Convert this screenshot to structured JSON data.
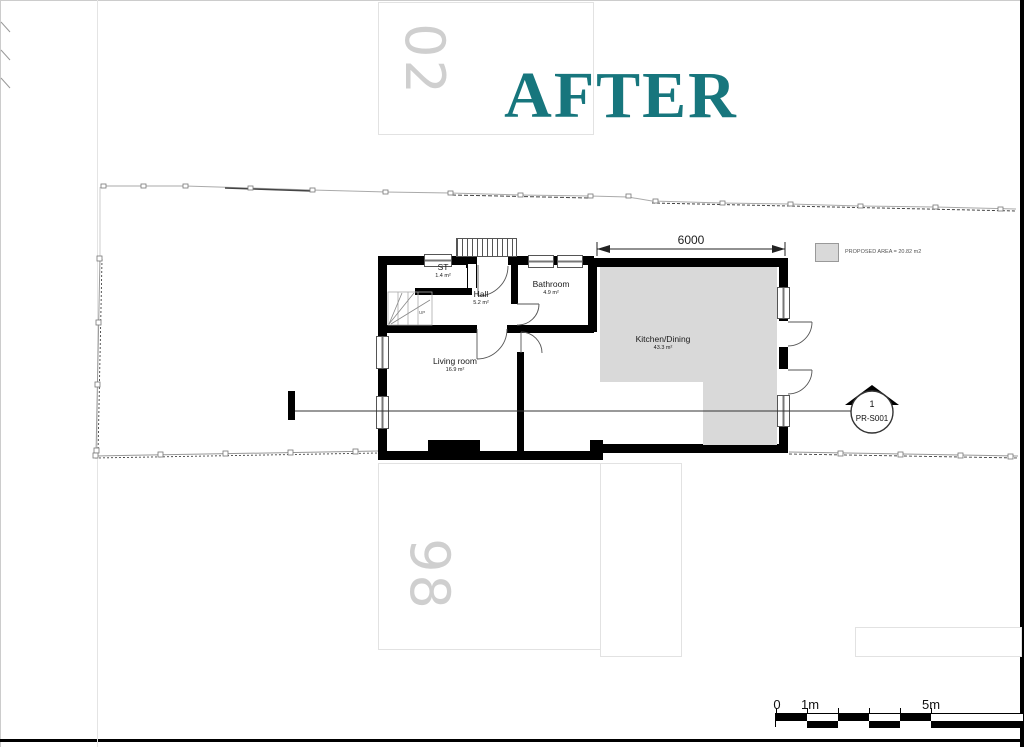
{
  "page": {
    "title": "AFTER",
    "title_color": "#17767d"
  },
  "neighbors": {
    "top_house_number": "02",
    "bottom_house_number": "98"
  },
  "plan": {
    "rooms": [
      {
        "name": "ST",
        "area": "1.4 m²"
      },
      {
        "name": "Hall",
        "area": "5.2 m²"
      },
      {
        "name": "Bathroom",
        "area": "4.9 m²"
      },
      {
        "name": "Living room",
        "area": "16.9 m²"
      },
      {
        "name": "Kitchen/Dining",
        "area": "43.3 m²"
      }
    ],
    "stairs_label": "UP",
    "dimension_label": "6000",
    "proposed_area_color": "#d9d9d9",
    "wall_color": "#000000"
  },
  "legend": {
    "label": "PROPOSED AREA = 20.82 m2"
  },
  "section_marker": {
    "number": "1",
    "label": "PR-S001"
  },
  "scale_bar": {
    "zero": "0",
    "one": "1m",
    "five": "5m"
  }
}
